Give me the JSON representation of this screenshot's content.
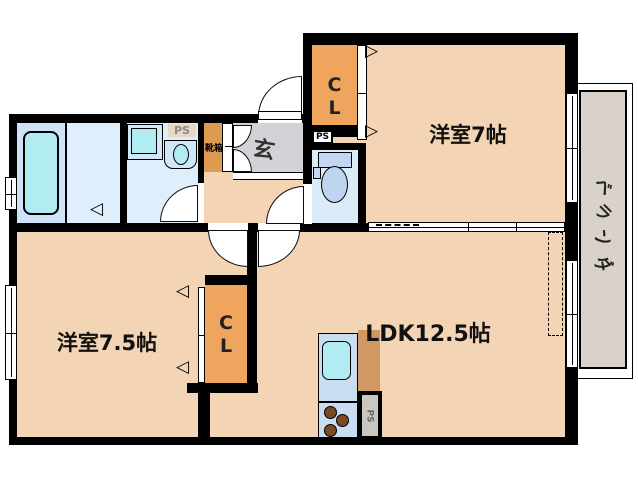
{
  "rooms": {
    "western7": {
      "label": "洋室7帖"
    },
    "western75": {
      "label": "洋室7.5帖"
    },
    "ldk": {
      "label": "LDK12.5帖"
    },
    "entrance": {
      "label": "玄"
    },
    "shoe_box": {
      "label": "靴箱"
    },
    "closet_top": {
      "line1": "C",
      "line2": "L"
    },
    "closet_mid": {
      "line1": "C",
      "line2": "L"
    },
    "veranda": {
      "label": "ベランダ",
      "chars": [
        "ベ",
        "ラ",
        "ン",
        "ダ"
      ]
    }
  },
  "pipe_spaces": {
    "washroom": "PS",
    "toilet": "PS",
    "kitchen": "PS"
  },
  "icons": {
    "slide_arrow_right": "▷",
    "slide_arrow_left": "◁"
  },
  "colors": {
    "wall": "#000000",
    "room_peach": "#f3d4b5",
    "closet_orange": "#f0a55e",
    "shoe_box_orange": "#dd9b52",
    "kitchen_side_orange": "#d09862",
    "water_room_blue": "#deeefb",
    "bathroom_blue": "#cfe3f8",
    "fixture_cyan": "#b2ecf3",
    "entrance_gray": "#d3d3d7",
    "veranda_gray": "#d9d2ca",
    "ps_beige": "#e7d8c3"
  }
}
